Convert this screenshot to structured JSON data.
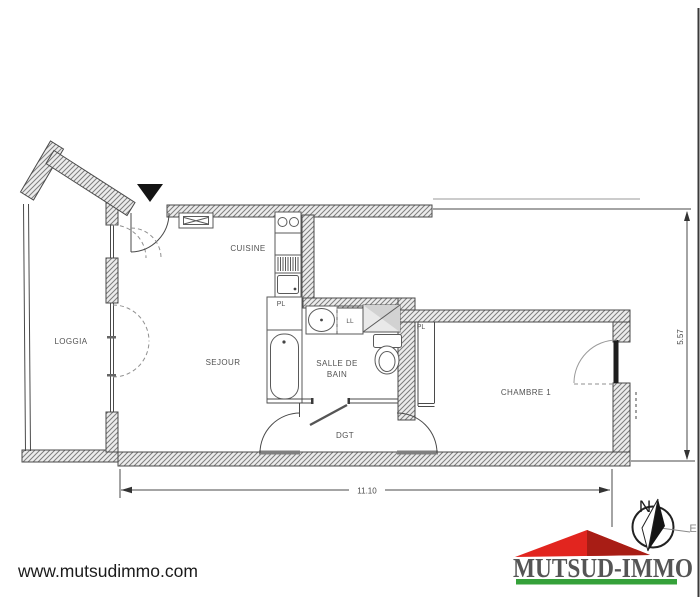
{
  "rooms": {
    "loggia": "LOGGIA",
    "sejour": "SEJOUR",
    "cuisine": "CUISINE",
    "salle_de_bain_line1": "SALLE DE",
    "salle_de_bain_line2": "BAIN",
    "dgt": "DGT",
    "chambre1": "CHAMBRE 1"
  },
  "closets": {
    "kitchen_pl": "PL",
    "chambre_pl": "PL",
    "washing_machine": "LL"
  },
  "dimensions": {
    "total_width_m": "11.10",
    "total_height_m": "5.57"
  },
  "compass": {
    "north": "N",
    "east": "E"
  },
  "footer": {
    "website": "www.mutsudimmo.com",
    "brand": "MUTSUD-IMMO"
  },
  "colors": {
    "brand_blue": "#2a3a9a",
    "roof_red": "#e2251f",
    "roof_dark_red": "#a81d15",
    "bar_green": "#35a13a",
    "wall_line": "#4a4a4a"
  }
}
